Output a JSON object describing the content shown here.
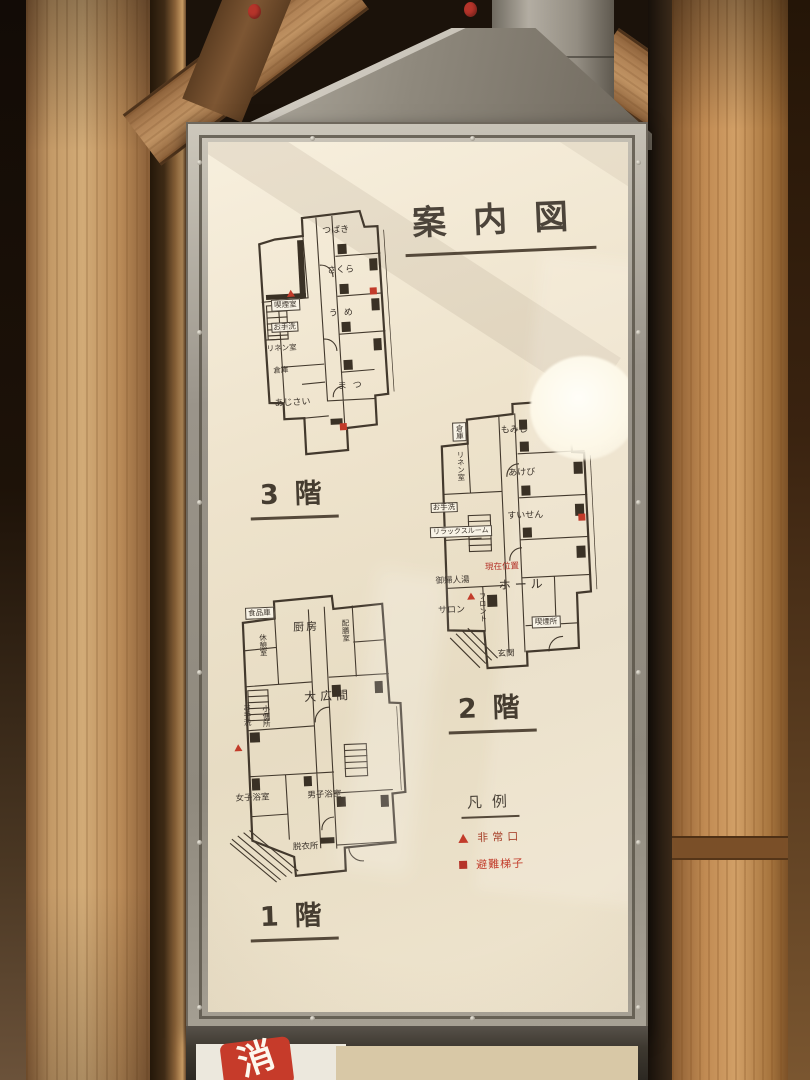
{
  "sign": {
    "title": "案内図",
    "floor3": {
      "label": "3階",
      "rooms": {
        "tsubaki": "つばき",
        "sakura": "さくら",
        "ume": "うめ",
        "smoking_room": "喫煙室",
        "toilet": "お手洗",
        "linen": "リネン室",
        "storage": "倉庫",
        "ajisai": "あじさい",
        "matsu": "まつ"
      }
    },
    "floor2": {
      "label": "2階",
      "rooms": {
        "storage": "倉庫",
        "linen": "リネン室",
        "momiji": "もみじ",
        "akebi": "あけび",
        "suisen": "すいせん",
        "toilet": "お手洗",
        "relax_room": "リラックスルーム",
        "ladies_bath": "御婦人湯",
        "salon": "サロン",
        "front_desk": "フロント",
        "hall": "ホール",
        "entrance": "玄関",
        "smoking_area": "喫煙所",
        "you_are_here": "現在位置"
      }
    },
    "floor1": {
      "label": "1階",
      "rooms": {
        "pantry": "食品庫",
        "rest_room": "休憩室",
        "kitchen": "厨房",
        "serving_room": "配膳室",
        "grand_hall": "大広間",
        "toilet": "お手洗",
        "urinal": "小便所",
        "womens_bath": "女子浴室",
        "mens_bath": "男子浴室",
        "dressing_room": "脱衣所"
      }
    },
    "legend": {
      "title": "凡例",
      "emergency_exit": "非常口",
      "escape_ladder": "避難梯子"
    }
  },
  "environment": {
    "extinguisher_sign": "消"
  },
  "colors": {
    "accent_red": "#c23b2a",
    "plan_line": "#43392d",
    "panel": "#eee3cc",
    "frame_metal": "#a8a296",
    "wood": "#c49a67"
  }
}
